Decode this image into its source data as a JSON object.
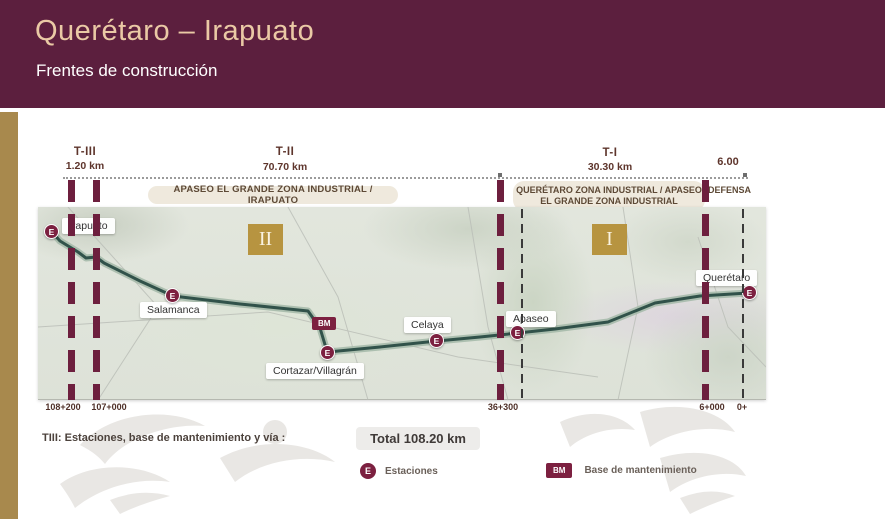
{
  "slide": {
    "title": "Querétaro – Irapuato",
    "subtitle": "Frentes de construcción"
  },
  "sections": [
    {
      "name": "T-III",
      "length": "1.20 km"
    },
    {
      "name": "T-II",
      "length": "70.70 km"
    },
    {
      "name": "T-I",
      "length": "30.30 km"
    },
    {
      "name": "DEFENSA",
      "length": "6.00"
    }
  ],
  "zones": {
    "zone1": "APASEO EL GRANDE ZONA INDUSTRIAL / IRAPUATO",
    "zone2_line1": "QUERÉTARO ZONA INDUSTRIAL / APASEO",
    "zone2_line2": "EL GRANDE ZONA INDUSTRIAL"
  },
  "fronts": [
    {
      "numeral": "II"
    },
    {
      "numeral": "I"
    }
  ],
  "stations": [
    {
      "name": "Irapuato",
      "symbol": "E"
    },
    {
      "name": "Salamanca",
      "symbol": "E"
    },
    {
      "name": "Cortazar/Villagrán",
      "symbol": "E"
    },
    {
      "name": "Celaya",
      "symbol": "E"
    },
    {
      "name": "Apaseo",
      "symbol": "E"
    },
    {
      "name": "Querétaro",
      "symbol": "E"
    }
  ],
  "maintenance_base": {
    "symbol": "BM"
  },
  "km_markers": [
    "108+200",
    "107+000",
    "36+300",
    "6+000",
    "0+"
  ],
  "footer": {
    "note": "TIII:  Estaciones, base de mantenimiento y vía :",
    "total": "Total 108.20 km",
    "legend": [
      {
        "symbol": "E",
        "label": "Estaciones"
      },
      {
        "symbol": "BM",
        "label": "Base de mantenimiento"
      }
    ]
  },
  "colors": {
    "header_bg": "#5C1F3E",
    "title_text": "#EAC9A5",
    "gold_bar": "#A8894D",
    "front_badge": "#B79440",
    "marker": "#7C2040",
    "route": "#31524A"
  }
}
